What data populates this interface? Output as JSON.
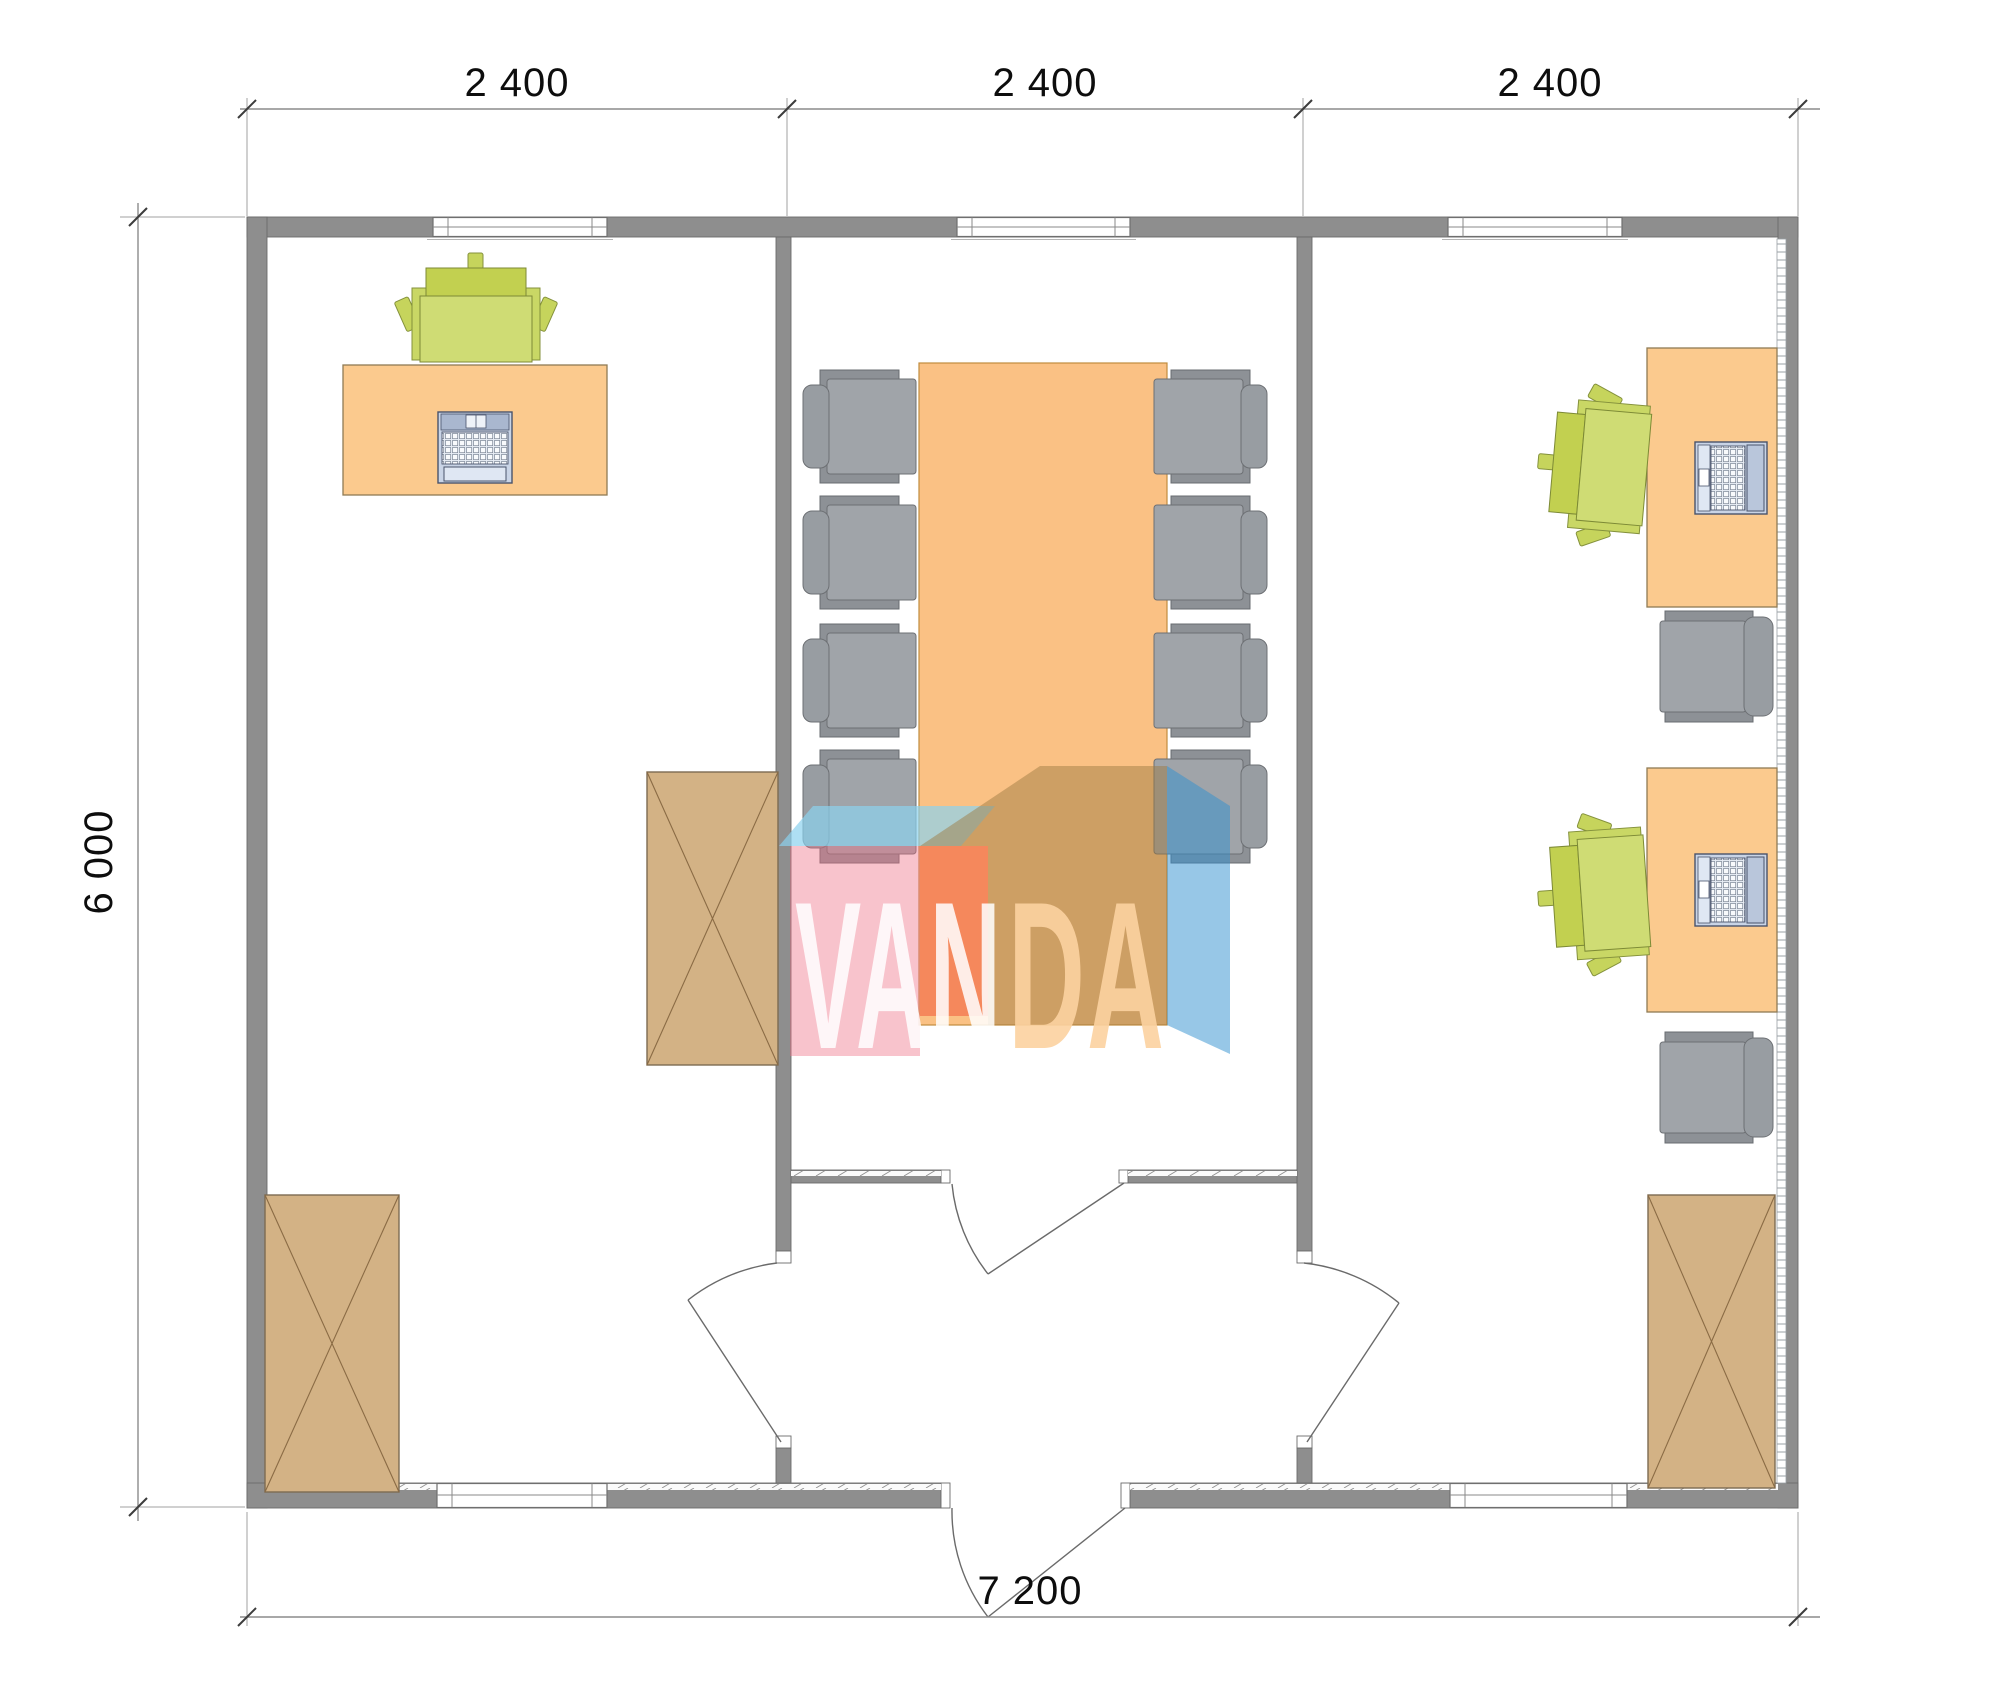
{
  "plan": {
    "title": "office-module-floor-plan",
    "dimensions": {
      "top_segments": [
        "2 400",
        "2 400",
        "2 400"
      ],
      "left_total": "6 000",
      "bottom_total": "7 200"
    },
    "watermark": {
      "text_left": "VAN",
      "text_right": "DA"
    },
    "rooms": {
      "left_office": [
        "desk with desktop computer",
        "green office chair",
        "wardrobe cabinet at partition",
        "wardrobe cabinet bottom-left"
      ],
      "meeting_room": [
        "conference table",
        "eight gray chairs",
        "double-leaf interior door"
      ],
      "right_office": [
        "two desks with laptops",
        "two green office chairs",
        "two gray side chairs",
        "wardrobe cabinet bottom-right"
      ]
    },
    "colors": {
      "wall": "#8e8e8e",
      "wall_outline": "#6b6b6b",
      "desk": "#fbca8e",
      "desk_outline": "#8f7b55",
      "meeting_table": "#fac184",
      "table_outline": "#c08c3e",
      "cabinet": "#d3b285",
      "cabinet_outline": "#7d6b52",
      "cabinet_cross": "#8a6b45",
      "chair_green_seat": "#cfdc74",
      "chair_green_back": "#c2d050",
      "chair_gray_seat": "#a0a4a9",
      "chair_gray_back": "#8d9196",
      "computer_body": "#c9d4e6",
      "watermark_cyan": "#8cd2ee",
      "watermark_pink": "#ee6f85",
      "watermark_red": "#f05a3c",
      "watermark_tan": "#9c7a40",
      "watermark_blue": "#2f8fd0",
      "watermark_text_left": "#ffffff",
      "watermark_text_right": "#fcd2a0",
      "dimension_text": "#0d0d0d"
    }
  }
}
